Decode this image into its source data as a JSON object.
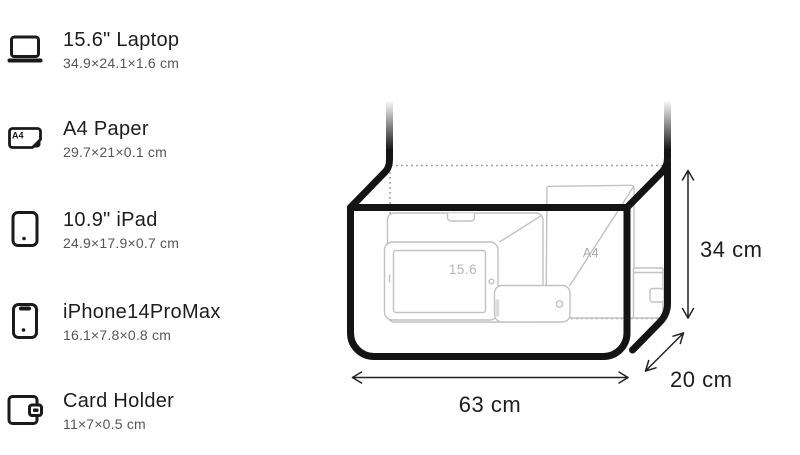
{
  "legend": {
    "items": [
      {
        "name": "15.6\" Laptop",
        "dims": "34.9×24.1×1.6 cm",
        "icon": "laptop-icon"
      },
      {
        "name": "A4 Paper",
        "dims": "29.7×21×0.1 cm",
        "icon": "a4-paper-icon",
        "icon_label": "A4"
      },
      {
        "name": "10.9\" iPad",
        "dims": "24.9×17.9×0.7 cm",
        "icon": "tablet-icon"
      },
      {
        "name": "iPhone14ProMax",
        "dims": "16.1×7.8×0.8 cm",
        "icon": "smartphone-icon"
      },
      {
        "name": "Card Holder",
        "dims": "11×7×0.5 cm",
        "icon": "card-holder-icon"
      }
    ]
  },
  "diagram": {
    "width_label": "63 cm",
    "height_label": "34 cm",
    "depth_label": "20 cm",
    "laptop_label": "15.6",
    "a4_label": "A4",
    "colors": {
      "bag_outline": "#141414",
      "item_wireframe": "#c2c2c2",
      "hidden_edge": "#999999",
      "dimension_line": "#222222",
      "dimension_text": "#1d1d1f",
      "wireframe_label": "#b0b0b0",
      "legend_title": "#1d1d1f",
      "legend_dims": "#56565a"
    }
  }
}
